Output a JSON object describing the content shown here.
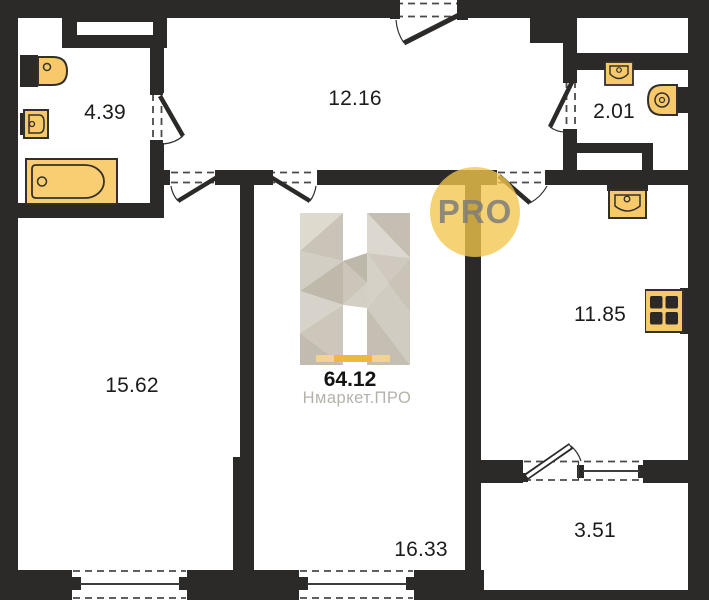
{
  "plan": {
    "badge_label": "PRO",
    "total_area_label": "64.12",
    "brand_watermark": "Нмаркет.ПРО",
    "rooms": {
      "bathroom": "4.39",
      "hallway": "12.16",
      "wc": "2.01",
      "living_room": "15.62",
      "kitchen": "11.85",
      "bedroom": "16.33",
      "balcony": "3.51"
    },
    "colors": {
      "wall": "#2b2a28",
      "fixture_fill": "#f8c96b",
      "fixture_outline": "#33302a",
      "accent_yellow": "#f2b63e",
      "badge_yellow": "#f2c54c",
      "badge_text": "#7d7c7a",
      "watermark_gray": "#b5b2ac",
      "label_black": "#1d1c1a"
    }
  }
}
